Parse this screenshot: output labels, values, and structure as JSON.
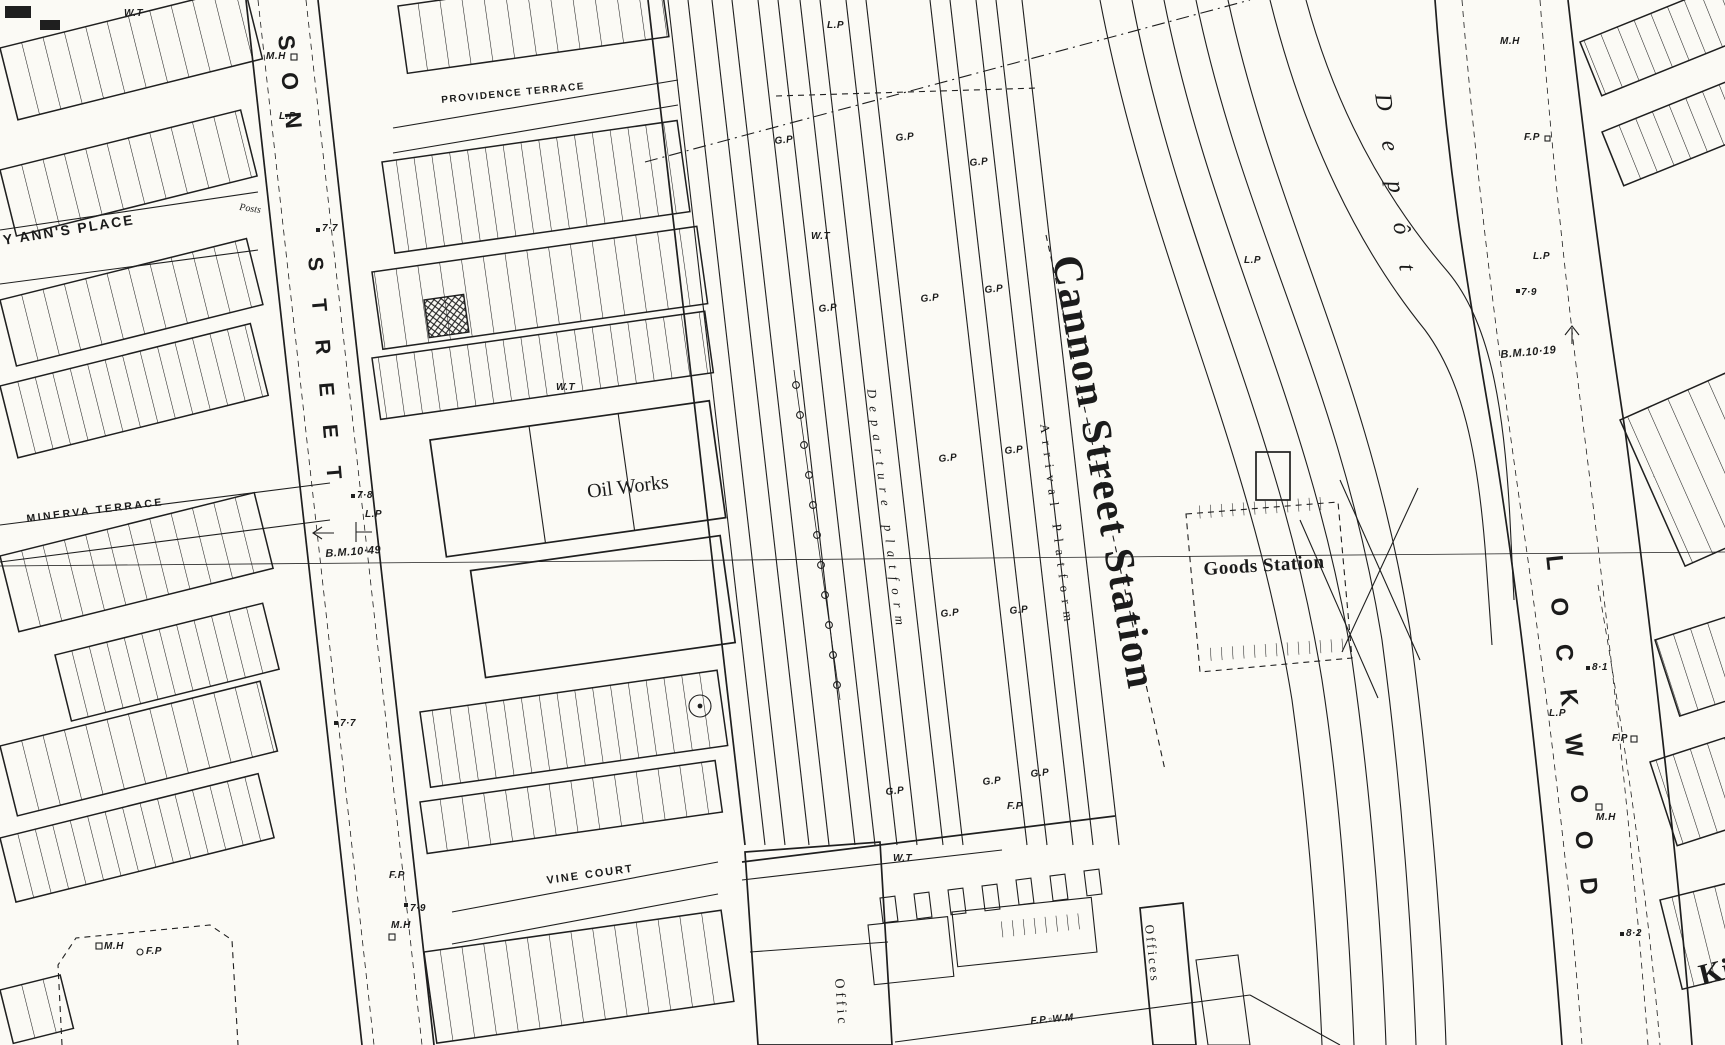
{
  "title": "Cannon Street Station",
  "streets": {
    "providence_terrace": "PROVIDENCE TERRACE",
    "anns_place": "Y ANN'S PLACE",
    "minerva_terrace": "MINERVA TERRACE",
    "vine_court": "VINE COURT",
    "son": "SON",
    "street": "STREET",
    "lockwood": "LOCKWOOD",
    "king_partial": "Ki"
  },
  "places": {
    "station": "Cannon Street Station",
    "goods_station": "Goods Station",
    "oil_works": "Oil Works",
    "depot": "Depôt",
    "arrival_platform": "Arrival Platform",
    "departure_platform": "Departure platform",
    "offices": "Offices",
    "offices_partial": "Offic",
    "posts": "Posts"
  },
  "markers": {
    "gp": "G.P",
    "lp": "L.P",
    "wt": "W.T",
    "fp": "F.P",
    "mh": "M.H",
    "fp_wm": "F.P.▫W.M"
  },
  "benchmarks": {
    "bm_10_49": "B.M.10·49",
    "bm_10_19": "B.M.10·19"
  },
  "spot_heights": {
    "h77": "7·7",
    "h78": "7·8",
    "h79": "7·9",
    "h81": "8·1",
    "h82": "8·2"
  },
  "colors": {
    "ink": "#1f1f1f",
    "paper": "#fbfaf5"
  }
}
